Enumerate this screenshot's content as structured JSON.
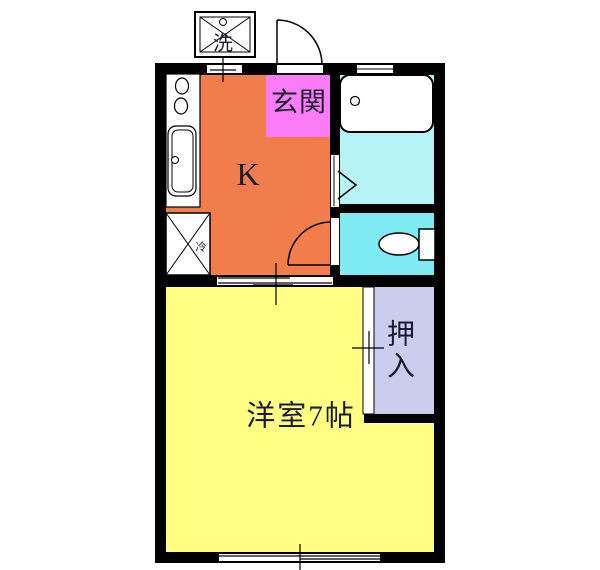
{
  "title": "1K apartment floor plan",
  "colors": {
    "wall": "#000000",
    "kitchen": "#F07D4B",
    "entrance": "#FA7DF7",
    "bathroom": "#B5F3F6",
    "toilet": "#7EEAF2",
    "living_room": "#FFFF84",
    "closet": "#CCCCEE",
    "fixture": "#FFFFFF",
    "opening": "#FFFFFF",
    "line": "#000000",
    "text": "#1C1C30"
  },
  "labels": {
    "kitchen": "K",
    "entrance": "玄関",
    "living_room": "洋室7帖",
    "closet": "押入",
    "washing_machine": "洗",
    "refrigerator": "冷"
  }
}
